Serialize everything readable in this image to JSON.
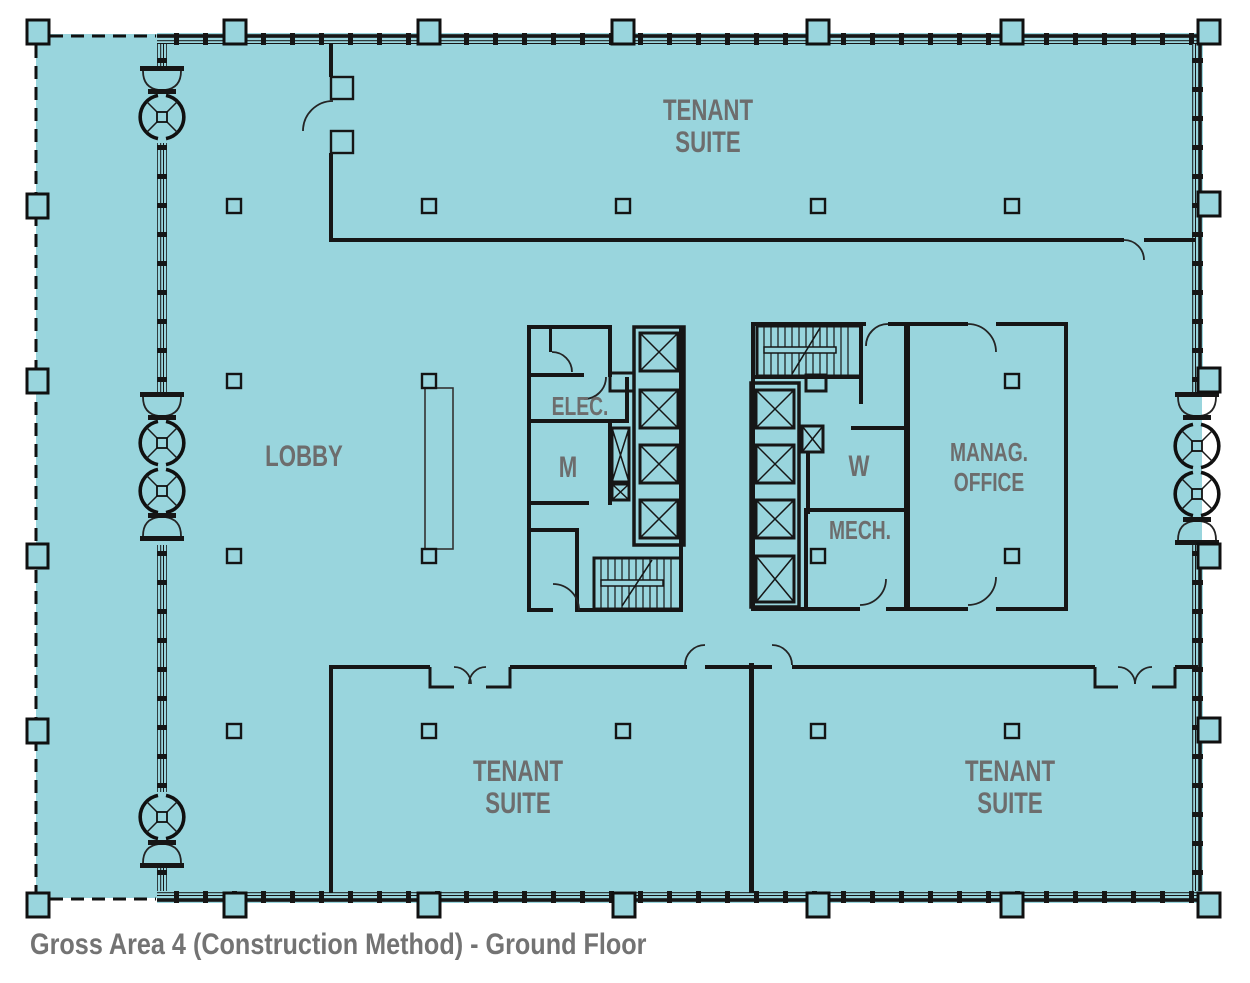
{
  "title": "Gross Area 4 (Construction Method) - Ground Floor",
  "colors": {
    "floor_fill": "#99d5dd",
    "wall_line": "#161616",
    "room_label": "#6d6d6d",
    "title_text": "#737373",
    "background": "#ffffff"
  },
  "rooms": {
    "tenant_suite_top": {
      "line1": "TENANT",
      "line2": "SUITE"
    },
    "lobby": {
      "label": "LOBBY"
    },
    "elec": {
      "label": "ELEC."
    },
    "men_restroom": {
      "label": "M"
    },
    "women_restroom": {
      "label": "W"
    },
    "management_office": {
      "line1": "MANAG.",
      "line2": "OFFICE"
    },
    "mech": {
      "label": "MECH."
    },
    "tenant_suite_bottom_left": {
      "line1": "TENANT",
      "line2": "SUITE"
    },
    "tenant_suite_bottom_right": {
      "line1": "TENANT",
      "line2": "SUITE"
    }
  },
  "symbols": {
    "revolving_door_count": 6,
    "elevator_shaft_count": 8,
    "stair_run_count": 2,
    "dashed_gross_area_boundary": true
  }
}
